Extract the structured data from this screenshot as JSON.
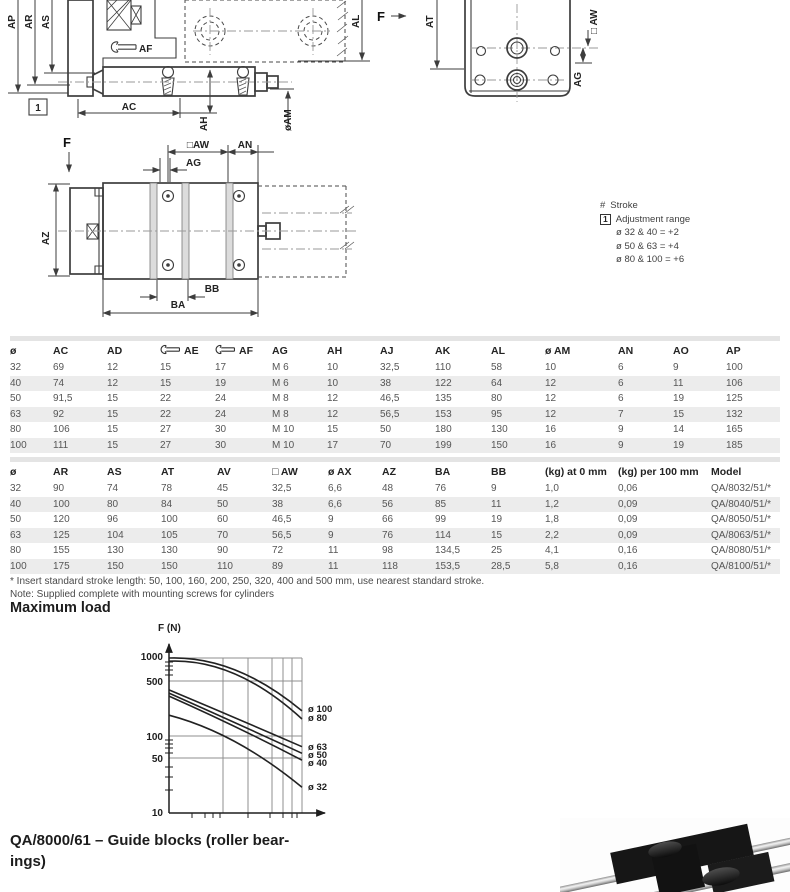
{
  "drawing": {
    "side": {
      "ap": "AP",
      "ar": "AR",
      "as": "AS",
      "af": "AF",
      "ref1": "1",
      "ac": "AC",
      "ah": "AH",
      "am": "øAM",
      "al": "AL",
      "f": "F"
    },
    "end": {
      "at": "AT",
      "aw": "□ AW",
      "ag": "AG"
    },
    "plan": {
      "f": "F",
      "aw": "□AW",
      "an": "AN",
      "ag": "AG",
      "az": "AZ",
      "bb": "BB",
      "ba": "BA"
    }
  },
  "stroke_note": {
    "hash": "#",
    "stroke": "Stroke",
    "ref": "1",
    "adjustment": "Adjustment range",
    "lines": [
      "ø 32 & 40 = +2",
      "ø 50 & 63 = +4",
      "ø 80 & 100 = +6"
    ]
  },
  "table1": {
    "headers": [
      "ø",
      "AC",
      "AD",
      "AE",
      "AF",
      "AG",
      "AH",
      "AJ",
      "AK",
      "AL",
      "ø AM",
      "AN",
      "AO",
      "AP"
    ],
    "wrench_cols": [
      3,
      4
    ],
    "rows": [
      [
        "32",
        "69",
        "12",
        "15",
        "17",
        "M 6",
        "10",
        "32,5",
        "110",
        "58",
        "10",
        "6",
        "9",
        "100"
      ],
      [
        "40",
        "74",
        "12",
        "15",
        "19",
        "M 6",
        "10",
        "38",
        "122",
        "64",
        "12",
        "6",
        "11",
        "106"
      ],
      [
        "50",
        "91,5",
        "15",
        "22",
        "24",
        "M 8",
        "12",
        "46,5",
        "135",
        "80",
        "12",
        "6",
        "19",
        "125"
      ],
      [
        "63",
        "92",
        "15",
        "22",
        "24",
        "M 8",
        "12",
        "56,5",
        "153",
        "95",
        "12",
        "7",
        "15",
        "132"
      ],
      [
        "80",
        "106",
        "15",
        "27",
        "30",
        "M 10",
        "15",
        "50",
        "180",
        "130",
        "16",
        "9",
        "14",
        "165"
      ],
      [
        "100",
        "111",
        "15",
        "27",
        "30",
        "M 10",
        "17",
        "70",
        "199",
        "150",
        "16",
        "9",
        "19",
        "185"
      ]
    ]
  },
  "table2": {
    "headers": [
      "ø",
      "AR",
      "AS",
      "AT",
      "AV",
      "□ AW",
      "ø AX",
      "AZ",
      "BA",
      "BB",
      "(kg) at 0 mm",
      "(kg) per 100 mm",
      "Model"
    ],
    "rows": [
      [
        "32",
        "90",
        "74",
        "78",
        "45",
        "32,5",
        "6,6",
        "48",
        "76",
        "9",
        "1,0",
        "0,06",
        "QA/8032/51/*"
      ],
      [
        "40",
        "100",
        "80",
        "84",
        "50",
        "38",
        "6,6",
        "56",
        "85",
        "11",
        "1,2",
        "0,09",
        "QA/8040/51/*"
      ],
      [
        "50",
        "120",
        "96",
        "100",
        "60",
        "46,5",
        "9",
        "66",
        "99",
        "19",
        "1,8",
        "0,09",
        "QA/8050/51/*"
      ],
      [
        "63",
        "125",
        "104",
        "105",
        "70",
        "56,5",
        "9",
        "76",
        "114",
        "15",
        "2,2",
        "0,09",
        "QA/8063/51/*"
      ],
      [
        "80",
        "155",
        "130",
        "130",
        "90",
        "72",
        "11",
        "98",
        "134,5",
        "25",
        "4,1",
        "0,16",
        "QA/8080/51/*"
      ],
      [
        "100",
        "175",
        "150",
        "150",
        "110",
        "89",
        "11",
        "118",
        "153,5",
        "28,5",
        "5,8",
        "0,16",
        "QA/8100/51/*"
      ]
    ]
  },
  "footnotes": [
    "* Insert standard stroke length: 50, 100, 160, 200, 250, 320, 400 and 500 mm, use nearest standard stroke.",
    "Note: Supplied complete with mounting screws for cylinders"
  ],
  "max_load": {
    "heading": "Maximum load",
    "ylabel": "F (N)",
    "y_ticks": [
      "1000",
      "500",
      "100",
      "50",
      "10"
    ],
    "curve_labels": [
      "ø 100",
      "ø 80",
      "ø 63",
      "ø 50",
      "ø 40",
      "ø 32"
    ]
  },
  "chart_data": {
    "type": "line",
    "title": "Maximum load",
    "xlabel": "",
    "ylabel": "F (N)",
    "x_axis": {
      "scale": "log",
      "tick_labels": []
    },
    "y_axis": {
      "scale": "log",
      "range": [
        10,
        1000
      ],
      "tick_labels": [
        10,
        50,
        100,
        500,
        1000
      ]
    },
    "grid": true,
    "legend_position": "right",
    "x_fracs": [
      0,
      0.5,
      1
    ],
    "series": [
      {
        "name": "ø 100",
        "values_N": [
          1000,
          700,
          210
        ]
      },
      {
        "name": "ø 80",
        "values_N": [
          910,
          620,
          165
        ]
      },
      {
        "name": "ø 63",
        "values_N": [
          390,
          170,
          73
        ]
      },
      {
        "name": "ø 50",
        "values_N": [
          355,
          147,
          60
        ]
      },
      {
        "name": "ø 40",
        "values_N": [
          325,
          131,
          49
        ]
      },
      {
        "name": "ø 32",
        "values_N": [
          185,
          84,
          22
        ]
      }
    ]
  },
  "guide_section": {
    "heading_lines": [
      "QA/8000/61 – Guide blocks (roller bear-",
      "ings)"
    ]
  },
  "colors": {
    "row_stripe": "#ececec",
    "text": "#3c3c3c",
    "line": "#3d3d3d"
  }
}
